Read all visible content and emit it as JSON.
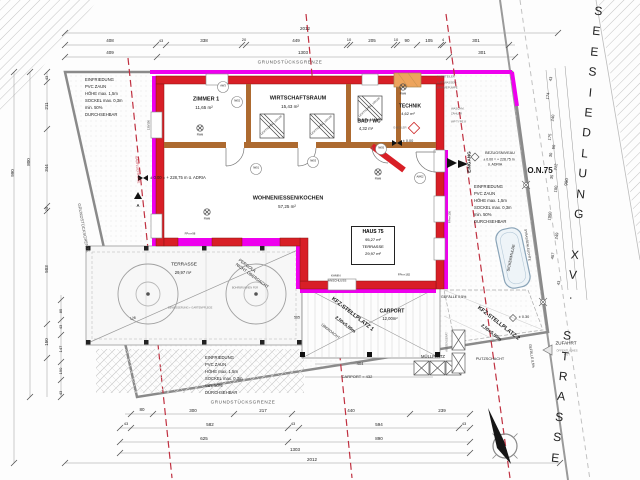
{
  "street": {
    "name": "SEESIEDLUNG XV. STRASSE"
  },
  "haus_box": {
    "title": "HAUS 75",
    "area": "95,27 m²",
    "terrasse_label": "TERRASSE",
    "terrasse_area": "29,97 m²"
  },
  "colors": {
    "wall_red": "#d81f26",
    "boundary_magenta": "#ee00ee",
    "interior_wall": "#ad6a30",
    "setback_red": "#c03040",
    "heatpump_orange": "#eda45c"
  },
  "annotations": [
    {
      "n": "dim",
      "t": "2012",
      "x": 305,
      "y": 29,
      "s": 4.5
    },
    {
      "n": "dim",
      "t": "408",
      "x": 110,
      "y": 41,
      "s": 4.5
    },
    {
      "n": "dim",
      "t": "43",
      "x": 161,
      "y": 41,
      "s": 4
    },
    {
      "n": "dim",
      "t": "338",
      "x": 204,
      "y": 41,
      "s": 4.5
    },
    {
      "n": "dim",
      "t": "20",
      "x": 244,
      "y": 40,
      "s": 4
    },
    {
      "n": "dim",
      "t": "449",
      "x": 296,
      "y": 41,
      "s": 4.5
    },
    {
      "n": "dim",
      "t": "10",
      "x": 349,
      "y": 40,
      "s": 4
    },
    {
      "n": "dim",
      "t": "205",
      "x": 372,
      "y": 41,
      "s": 4.5
    },
    {
      "n": "dim",
      "t": "10",
      "x": 396,
      "y": 40,
      "s": 4
    },
    {
      "n": "dim",
      "t": "90",
      "x": 407,
      "y": 41,
      "s": 4.5
    },
    {
      "n": "dim",
      "t": "105",
      "x": 429,
      "y": 41,
      "s": 4.5
    },
    {
      "n": "dim",
      "t": "4",
      "x": 443,
      "y": 40,
      "s": 4
    },
    {
      "n": "dim",
      "t": "301",
      "x": 476,
      "y": 41,
      "s": 4.5
    },
    {
      "n": "dim",
      "t": "409",
      "x": 110,
      "y": 53,
      "s": 4.5
    },
    {
      "n": "dim",
      "t": "1303",
      "x": 303,
      "y": 53,
      "s": 4.5
    },
    {
      "n": "dim",
      "t": "301",
      "x": 482,
      "y": 53,
      "s": 4.5
    },
    {
      "n": "boundary-label",
      "t": "GRUNDSTÜCKSGRENZE",
      "x": 290,
      "y": 63,
      "s": 4.6,
      "c": "#555",
      "ls": 0.6
    },
    {
      "n": "boundary-label",
      "t": "GRUNDSTÜCKSGRENZE",
      "x": 243,
      "y": 403,
      "s": 4.6,
      "c": "#555",
      "ls": 0.6
    },
    {
      "n": "dim",
      "t": "80",
      "x": 142,
      "y": 410,
      "s": 4.5
    },
    {
      "n": "dim",
      "t": "300",
      "x": 193,
      "y": 411,
      "s": 4.5
    },
    {
      "n": "dim",
      "t": "217",
      "x": 263,
      "y": 411,
      "s": 4.5
    },
    {
      "n": "dim",
      "t": "440",
      "x": 351,
      "y": 411,
      "s": 4.5
    },
    {
      "n": "dim",
      "t": "239",
      "x": 442,
      "y": 411,
      "s": 4.5
    },
    {
      "n": "dim",
      "t": "43",
      "x": 126,
      "y": 424,
      "s": 4
    },
    {
      "n": "dim",
      "t": "582",
      "x": 210,
      "y": 425,
      "s": 4.5
    },
    {
      "n": "dim",
      "t": "43",
      "x": 293,
      "y": 424,
      "s": 4
    },
    {
      "n": "dim",
      "t": "594",
      "x": 379,
      "y": 425,
      "s": 4.5
    },
    {
      "n": "dim",
      "t": "43",
      "x": 464,
      "y": 424,
      "s": 4
    },
    {
      "n": "dim",
      "t": "625",
      "x": 204,
      "y": 439,
      "s": 4.5
    },
    {
      "n": "dim",
      "t": "890",
      "x": 379,
      "y": 439,
      "s": 4.5
    },
    {
      "n": "dim",
      "t": "1303",
      "x": 295,
      "y": 450,
      "s": 4.5
    },
    {
      "n": "dim",
      "t": "2012",
      "x": 312,
      "y": 460,
      "s": 4.5
    },
    {
      "n": "dim",
      "t": "43",
      "x": 47,
      "y": 78,
      "s": 4,
      "r": -90
    },
    {
      "n": "dim",
      "t": "211",
      "x": 47,
      "y": 106,
      "s": 4.5,
      "r": -90
    },
    {
      "n": "dim",
      "t": "344",
      "x": 47,
      "y": 168,
      "s": 4.5,
      "r": -90
    },
    {
      "n": "dim",
      "t": "25",
      "x": 47,
      "y": 209,
      "s": 4,
      "r": -90
    },
    {
      "n": "dim",
      "t": "503",
      "x": 47,
      "y": 269,
      "s": 4.5,
      "r": -90
    },
    {
      "n": "dim",
      "t": "150",
      "x": 47,
      "y": 342,
      "s": 4.5,
      "r": -90
    },
    {
      "n": "dim",
      "t": "85",
      "x": 61,
      "y": 311,
      "s": 4,
      "r": -90
    },
    {
      "n": "dim",
      "t": "43",
      "x": 61,
      "y": 327,
      "s": 4,
      "r": -90
    },
    {
      "n": "dim",
      "t": "147",
      "x": 61,
      "y": 349,
      "s": 4,
      "r": -90
    },
    {
      "n": "dim",
      "t": "190",
      "x": 61,
      "y": 371,
      "s": 4,
      "r": -90
    },
    {
      "n": "dim",
      "t": "43",
      "x": 61,
      "y": 393,
      "s": 4,
      "r": -90
    },
    {
      "n": "dim",
      "t": "800",
      "x": 29,
      "y": 162,
      "s": 4.5,
      "r": -90
    },
    {
      "n": "dim",
      "t": "990",
      "x": 13,
      "y": 173,
      "s": 4.5,
      "r": -90
    },
    {
      "n": "dim",
      "t": "128",
      "x": 133,
      "y": 319,
      "s": 3.5,
      "r": -9
    },
    {
      "n": "dim",
      "t": "565",
      "x": 297,
      "y": 318,
      "s": 3.5
    },
    {
      "n": "dim",
      "t": "43",
      "x": 551,
      "y": 79,
      "s": 4,
      "r": -82
    },
    {
      "n": "dim",
      "t": "174",
      "x": 548,
      "y": 96,
      "s": 4,
      "r": -82
    },
    {
      "n": "dim",
      "t": "240",
      "x": 553,
      "y": 118,
      "s": 4,
      "r": -82
    },
    {
      "n": "dim",
      "t": "175",
      "x": 550,
      "y": 137,
      "s": 4,
      "r": -82
    },
    {
      "n": "dim",
      "t": "50",
      "x": 554,
      "y": 147,
      "s": 4,
      "r": -82
    },
    {
      "n": "dim",
      "t": "30",
      "x": 551,
      "y": 155,
      "s": 4,
      "r": -82
    },
    {
      "n": "dim",
      "t": "212",
      "x": 556,
      "y": 167,
      "s": 4,
      "r": -82
    },
    {
      "n": "dim",
      "t": "35",
      "x": 552,
      "y": 177,
      "s": 4,
      "r": -82
    },
    {
      "n": "dim",
      "t": "100",
      "x": 556,
      "y": 189,
      "s": 4,
      "r": -82
    },
    {
      "n": "dim",
      "t": "1050",
      "x": 550,
      "y": 216,
      "s": 4,
      "r": -82
    },
    {
      "n": "dim",
      "t": "249",
      "x": 557,
      "y": 236,
      "s": 4,
      "r": -82
    },
    {
      "n": "dim",
      "t": "407",
      "x": 553,
      "y": 256,
      "s": 4,
      "r": -82
    },
    {
      "n": "dim",
      "t": "43",
      "x": 559,
      "y": 283,
      "s": 4,
      "r": -82
    },
    {
      "n": "dim",
      "t": "990",
      "x": 567,
      "y": 182,
      "s": 4.5,
      "r": -82
    },
    {
      "n": "room-name",
      "t": "ZIMMER 1",
      "x": 206,
      "y": 100,
      "s": 5.5,
      "w": 700
    },
    {
      "n": "room-area",
      "t": "11,65 m²",
      "x": 204,
      "y": 108,
      "s": 4.5
    },
    {
      "n": "room-name",
      "t": "WIRTSCHAFTSRAUM",
      "x": 298,
      "y": 99,
      "s": 5.5,
      "w": 700
    },
    {
      "n": "room-area",
      "t": "15,43 m²",
      "x": 290,
      "y": 107,
      "s": 4.5
    },
    {
      "n": "room-name",
      "t": "BAD / WC",
      "x": 369,
      "y": 122,
      "s": 5,
      "w": 700
    },
    {
      "n": "room-area",
      "t": "4,32 m²",
      "x": 366,
      "y": 129,
      "s": 4.2
    },
    {
      "n": "room-name",
      "t": "TECHNIK",
      "x": 410,
      "y": 107,
      "s": 5,
      "w": 700
    },
    {
      "n": "room-area",
      "t": "4,62 m²",
      "x": 408,
      "y": 114,
      "s": 4
    },
    {
      "n": "room-name",
      "t": "WOHNEN/ESSEN/KOCHEN",
      "x": 288,
      "y": 199,
      "s": 5.5,
      "w": 700
    },
    {
      "n": "room-area",
      "t": "57,25 m²",
      "x": 287,
      "y": 207,
      "s": 4.5
    },
    {
      "n": "room-name",
      "t": "TERRASSE",
      "x": 184,
      "y": 266,
      "s": 4.8
    },
    {
      "n": "room-area",
      "t": "29,97 m²",
      "x": 183,
      "y": 273,
      "s": 4.2
    },
    {
      "n": "room-name",
      "t": "CARPORT",
      "x": 392,
      "y": 312,
      "s": 5,
      "w": 700
    },
    {
      "n": "room-area",
      "t": "12,00m²",
      "x": 390,
      "y": 319,
      "s": 4.2
    },
    {
      "n": "parking-label",
      "t": "KFZ-STELLPLATZ 1",
      "x": 352,
      "y": 315,
      "s": 5.5,
      "r": 38,
      "w": 700
    },
    {
      "n": "parking-size",
      "t": "2,50x5,00m",
      "x": 345,
      "y": 325,
      "s": 4.6,
      "r": 38,
      "w": 600
    },
    {
      "n": "parking-label",
      "t": "KFZ-STELLPLATZ 2",
      "x": 498,
      "y": 324,
      "s": 5.5,
      "r": 38,
      "w": 700
    },
    {
      "n": "parking-size",
      "t": "2,50x5,00m",
      "x": 491,
      "y": 333,
      "s": 4.6,
      "r": 38,
      "w": 600
    },
    {
      "n": "area-label",
      "t": "MÜLLPLATZ",
      "x": 433,
      "y": 357,
      "s": 4.2
    },
    {
      "n": "area-label",
      "t": "SICKERMULDE",
      "x": 512,
      "y": 258,
      "s": 3.8,
      "r": -78
    },
    {
      "n": "note",
      "t": "ÜBERDACHT",
      "x": 330,
      "y": 332,
      "s": 3.6,
      "r": 38
    },
    {
      "n": "note",
      "t": "PERGOLA",
      "x": 247,
      "y": 266,
      "s": 4.2,
      "r": 36
    },
    {
      "n": "note",
      "t": "NICHT ÜBERDACHT",
      "x": 252,
      "y": 276,
      "s": 4.2,
      "r": 36
    },
    {
      "n": "fence-note",
      "t": "EINFRIEDUNG",
      "x": 85,
      "y": 80,
      "s": 4.2,
      "a": "l"
    },
    {
      "n": "fence-note",
      "t": "PVC ZAUN",
      "x": 85,
      "y": 87,
      "s": 4.2,
      "a": "l"
    },
    {
      "n": "fence-note",
      "t": "HÖHE max. 1,5m",
      "x": 85,
      "y": 94,
      "s": 4.2,
      "a": "l"
    },
    {
      "n": "fence-note",
      "t": "SOCKEL max. 0,3m",
      "x": 85,
      "y": 101,
      "s": 4.2,
      "a": "l"
    },
    {
      "n": "fence-note",
      "t": "min. 50%",
      "x": 85,
      "y": 108,
      "s": 4.2,
      "a": "l"
    },
    {
      "n": "fence-note",
      "t": "DURCHSEHBAR",
      "x": 85,
      "y": 115,
      "s": 4.2,
      "a": "l"
    },
    {
      "n": "fence-note",
      "t": "EINFRIEDUNG",
      "x": 474,
      "y": 187,
      "s": 4.2,
      "a": "l"
    },
    {
      "n": "fence-note",
      "t": "PVC ZAUN",
      "x": 474,
      "y": 194,
      "s": 4.2,
      "a": "l"
    },
    {
      "n": "fence-note",
      "t": "HÖHE max. 1,5m",
      "x": 474,
      "y": 201,
      "s": 4.2,
      "a": "l"
    },
    {
      "n": "fence-note",
      "t": "SOCKEL max. 0,3m",
      "x": 474,
      "y": 208,
      "s": 4.2,
      "a": "l"
    },
    {
      "n": "fence-note",
      "t": "min. 50%",
      "x": 474,
      "y": 215,
      "s": 4.2,
      "a": "l"
    },
    {
      "n": "fence-note",
      "t": "DURCHSEHBAR",
      "x": 474,
      "y": 222,
      "s": 4.2,
      "a": "l"
    },
    {
      "n": "fence-note",
      "t": "EINFRIEDUNG",
      "x": 205,
      "y": 358,
      "s": 4.2,
      "a": "l"
    },
    {
      "n": "fence-note",
      "t": "PVC ZAUN",
      "x": 205,
      "y": 365,
      "s": 4.2,
      "a": "l"
    },
    {
      "n": "fence-note",
      "t": "HÖHE max. 1,5m",
      "x": 205,
      "y": 372,
      "s": 4.2,
      "a": "l"
    },
    {
      "n": "fence-note",
      "t": "SOCKEL max. 0,3m",
      "x": 205,
      "y": 379,
      "s": 4.2,
      "a": "l"
    },
    {
      "n": "fence-note",
      "t": "min. 50%",
      "x": 205,
      "y": 386,
      "s": 4.2,
      "a": "l"
    },
    {
      "n": "fence-note",
      "t": "DURCHSEHBAR",
      "x": 205,
      "y": 393,
      "s": 4.2,
      "a": "l"
    },
    {
      "n": "level-label",
      "t": "± 0.00 = + 228,75 m ü. ADRIA",
      "x": 150,
      "y": 178,
      "s": 4.2,
      "a": "l"
    },
    {
      "n": "boundary-label",
      "t": "GRUNDSTÜCKSGRENZE",
      "x": 83,
      "y": 228,
      "s": 4.2,
      "r": 80,
      "c": "#555"
    },
    {
      "n": "entrance-label",
      "t": "EINGANG",
      "x": 470,
      "y": 162,
      "s": 4.6,
      "r": -90,
      "w": 700
    },
    {
      "n": "level-label",
      "t": "BEZUGSNIVEAU",
      "x": 500,
      "y": 154,
      "s": 3.8
    },
    {
      "n": "level-label",
      "t": "± 0.00 = + 228.75 m",
      "x": 499,
      "y": 160,
      "s": 3.5
    },
    {
      "n": "level-label",
      "t": "ü. ADRIA",
      "x": 495,
      "y": 165,
      "s": 3.5
    },
    {
      "n": "house-number",
      "t": "O.N.75",
      "x": 540,
      "y": 171,
      "s": 8,
      "w": 600
    },
    {
      "n": "access-label",
      "t": "ZUFAHRT",
      "x": 566,
      "y": 344,
      "s": 4.6
    },
    {
      "n": "access-note",
      "t": "ÖFFENTLICHES",
      "x": 567,
      "y": 351,
      "s": 2.8,
      "c": "#888"
    },
    {
      "n": "access-note",
      "t": "GUT",
      "x": 567,
      "y": 355,
      "s": 2.8,
      "c": "#888"
    },
    {
      "n": "area-label",
      "t": "PUTZSCHACHT",
      "x": 490,
      "y": 360,
      "s": 3.8
    },
    {
      "n": "slope-label",
      "t": "GEFÄLLE 0,5%",
      "x": 441,
      "y": 298,
      "s": 3.6,
      "a": "l"
    },
    {
      "n": "slope-label",
      "t": "GEFÄLLE 0,5%",
      "x": 531,
      "y": 356,
      "s": 3.4,
      "r": 82
    },
    {
      "n": "level-label",
      "t": "± 0.30",
      "x": 524,
      "y": 318,
      "s": 3.8
    },
    {
      "n": "level-label",
      "t": "± 0.00",
      "x": 408,
      "y": 142,
      "s": 3.8
    },
    {
      "n": "note",
      "t": "KAMIN",
      "x": 331,
      "y": 276,
      "s": 3,
      "a": "l"
    },
    {
      "n": "note",
      "t": "ANSCHLUSS",
      "x": 328,
      "y": 281,
      "s": 3,
      "a": "l"
    },
    {
      "n": "street-lamp-label",
      "t": "STRASSENLEUCHTE",
      "x": 527,
      "y": 245,
      "s": 3.2,
      "r": 82
    },
    {
      "n": "setback-label",
      "t": "BAUFLUCHTLINIE",
      "x": 137,
      "y": 170,
      "s": 3.2,
      "r": 85,
      "c": "#c03040"
    },
    {
      "n": "skylight-label",
      "t": "LICHTKUPPEL 100/100",
      "x": 272,
      "y": 126,
      "s": 2.6,
      "r": -42
    },
    {
      "n": "skylight-label",
      "t": "LICHTKUPPEL 100/100",
      "x": 322,
      "y": 126,
      "s": 2.6,
      "r": -42
    },
    {
      "n": "skylight-label",
      "t": "LICHTKUPPEL 100/100",
      "x": 370,
      "y": 108,
      "s": 2.6,
      "r": -42
    },
    {
      "n": "hvac-note",
      "t": "2 VERTEILER",
      "x": 437,
      "y": 77,
      "s": 2.8,
      "a": "l",
      "c": "#666"
    },
    {
      "n": "hvac-note",
      "t": "LUFTWASSER-",
      "x": 437,
      "y": 83,
      "s": 2.8,
      "a": "l",
      "c": "#666"
    },
    {
      "n": "hvac-note",
      "t": "WÄRMEPUMPE",
      "x": 437,
      "y": 88,
      "s": 2.8,
      "a": "l",
      "c": "#666"
    },
    {
      "n": "hvac-note",
      "t": "WASCHM.",
      "x": 451,
      "y": 109,
      "s": 2.8,
      "a": "l",
      "c": "#666"
    },
    {
      "n": "hvac-note",
      "t": "ZÄHLER",
      "x": 451,
      "y": 114,
      "s": 2.8,
      "a": "l",
      "c": "#666"
    },
    {
      "n": "hvac-note",
      "t": "WP TYPE 8",
      "x": 451,
      "y": 122,
      "s": 2.8,
      "a": "l",
      "c": "#666"
    },
    {
      "n": "hvac-note",
      "t": "E-BOILER",
      "x": 400,
      "y": 128,
      "s": 2.8,
      "c": "#666"
    },
    {
      "n": "hvac-note",
      "t": "AUSSENGERÄT",
      "x": 448,
      "y": 342,
      "s": 2.6,
      "r": -90,
      "c": "#666"
    },
    {
      "n": "smoke-detector-label",
      "t": "RWM",
      "x": 200,
      "y": 136,
      "s": 2.6
    },
    {
      "n": "smoke-detector-label",
      "t": "RWM",
      "x": 378,
      "y": 180,
      "s": 2.6
    },
    {
      "n": "smoke-detector-label",
      "t": "RWM",
      "x": 403,
      "y": 95,
      "s": 2.6
    },
    {
      "n": "smoke-detector-label",
      "t": "RWM",
      "x": 207,
      "y": 220,
      "s": 2.6
    },
    {
      "n": "section-marker-label",
      "t": "A",
      "x": 138,
      "y": 206,
      "s": 4.2,
      "w": 600
    },
    {
      "n": "window-tag",
      "t": "FPm+98",
      "x": 190,
      "y": 234,
      "s": 2.8
    },
    {
      "n": "window-tag",
      "t": "FPm+182",
      "x": 404,
      "y": 275,
      "s": 2.8
    },
    {
      "n": "window-tag",
      "t": "FPm+150",
      "x": 450,
      "y": 217,
      "s": 2.8,
      "r": -90
    },
    {
      "n": "window-tag",
      "t": "130/150",
      "x": 149,
      "y": 125,
      "s": 2.8,
      "r": -90
    },
    {
      "n": "dim",
      "t": "404",
      "x": 360,
      "y": 364,
      "s": 4
    },
    {
      "n": "dim",
      "t": "CARPORT = 432",
      "x": 357,
      "y": 377,
      "s": 4
    },
    {
      "n": "window-tag",
      "t": "AW3",
      "x": 223,
      "y": 87,
      "s": 2.6
    },
    {
      "n": "window-tag",
      "t": "IW02",
      "x": 237,
      "y": 102,
      "s": 2.6
    },
    {
      "n": "window-tag",
      "t": "IW01",
      "x": 256,
      "y": 169,
      "s": 2.6
    },
    {
      "n": "window-tag",
      "t": "IW03",
      "x": 313,
      "y": 162,
      "s": 2.6
    },
    {
      "n": "window-tag",
      "t": "IW05",
      "x": 381,
      "y": 149,
      "s": 2.6
    },
    {
      "n": "window-tag",
      "t": "AW02",
      "x": 420,
      "y": 178,
      "s": 2.6
    },
    {
      "n": "garden-note",
      "t": "BOHRBRUNNEN FÜR",
      "x": 245,
      "y": 289,
      "s": 2.6,
      "c": "#777"
    },
    {
      "n": "garden-note",
      "t": "BEWÄSSERUNG + GARTENPFLEGE",
      "x": 168,
      "y": 309,
      "s": 2.6,
      "a": "l",
      "c": "#777"
    }
  ]
}
